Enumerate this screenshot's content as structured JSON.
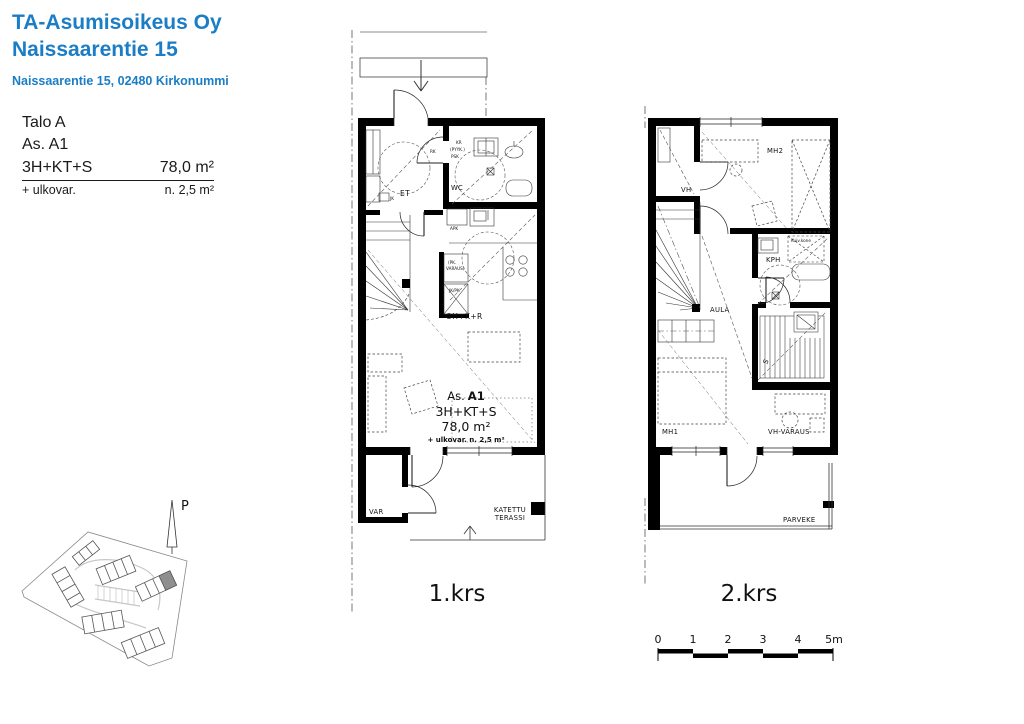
{
  "header": {
    "company": "TA-Asumisoikeus Oy",
    "project": "Naissaarentie 15",
    "address": "Naissaarentie 15, 02480 Kirkonummi"
  },
  "info": {
    "building": "Talo A",
    "apartment": "As. A1",
    "layout": "3H+KT+S",
    "area": "78,0 m²",
    "extra_label": "+ ulkovar.",
    "extra_area": "n. 2,5 m²"
  },
  "floor1": {
    "caption": "1.krs",
    "rooms": {
      "et": "ET",
      "wc": "WC",
      "living": "OH+K+R",
      "storage": "VAR"
    },
    "terrace_line1": "KATETTU",
    "terrace_line2": "TERASSI",
    "labels": {
      "kr": "KR",
      "pyyk": "(PYYK.)",
      "psk": "PSK",
      "apk": "APK",
      "pk1": "(PK.",
      "pk2": "VARAUS)",
      "jkpk": "JK/PK",
      "jk": "JK",
      "rk": "RK"
    },
    "unit": {
      "as_label": "As.",
      "as_value": "A1",
      "layout": "3H+KT+S",
      "area": "78,0 m²",
      "extra": "+ ulkovar. n. 2,5 m²"
    }
  },
  "floor2": {
    "caption": "2.krs",
    "rooms": {
      "mh2": "MH2",
      "vh": "VH",
      "kph": "KPH",
      "aula": "AULA",
      "sauna": "S",
      "mh1": "MH1",
      "vh_varaus": "VH-VARAUS",
      "balcony": "PARVEKE"
    },
    "labels": {
      "dryer": "Kuiv.kone"
    }
  },
  "site": {
    "north_label": "P"
  },
  "scalebar": {
    "ticks": [
      "0",
      "1",
      "2",
      "3",
      "4",
      "5m"
    ]
  },
  "colors": {
    "brand_blue": "#1a7dc5",
    "wall_black": "#000000",
    "unit_highlight": "#8f8f8f"
  }
}
